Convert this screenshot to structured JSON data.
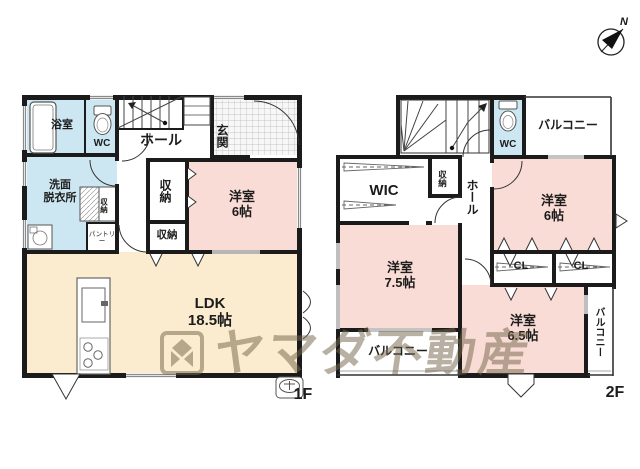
{
  "title": "間取り図",
  "compass": {
    "north_label": "N"
  },
  "watermark": {
    "text": "ヤマダ不動産",
    "logo": "yamada-diamond-logo",
    "color": "#76684c"
  },
  "palette": {
    "wall": "#1b1b1b",
    "room_pink": "#f8dcd5",
    "room_blue": "#cde7f2",
    "room_cream": "#fbeccf",
    "tile_line": "#b5b5b5"
  },
  "floor1": {
    "label": "1F",
    "rooms": {
      "bath": "浴室",
      "wc": "WC",
      "hall": "ホール",
      "entrance": "玄関",
      "washroom": "洗面\n脱衣所",
      "closet_small": "収納",
      "pantry": "パントリー",
      "closet_tall": "収納",
      "closet_lower": "収納",
      "bedroom6": "洋室\n6帖",
      "ldk": "LDK\n18.5帖"
    }
  },
  "floor2": {
    "label": "2F",
    "rooms": {
      "wc": "WC",
      "balcony_top": "バルコニー",
      "wic": "WIC",
      "closet": "収納",
      "hall": "ホール",
      "bedroom6": "洋室\n6帖",
      "cl_left": "CL",
      "cl_right": "CL",
      "bedroom75": "洋室\n7.5帖",
      "bedroom65": "洋室\n6.5帖",
      "balcony_right": "バルコニー",
      "balcony_bottom": "バルコニー"
    }
  }
}
